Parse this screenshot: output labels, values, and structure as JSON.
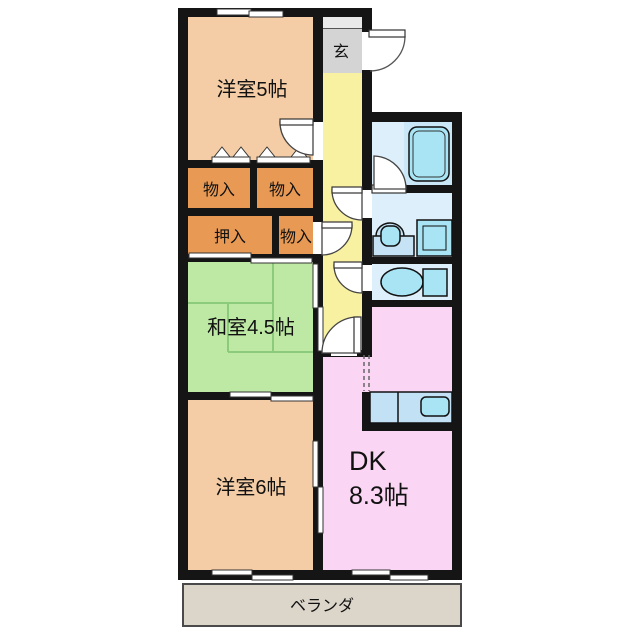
{
  "title": "apartment floor plan",
  "labels": {
    "yoshitsu5": "洋室5帖",
    "genkan": "玄",
    "monoire_a": "物入",
    "monoire_b": "物入",
    "oshiire": "押入",
    "monoire_c": "物入",
    "washitsu": "和室4.5帖",
    "yoshitsu6": "洋室6帖",
    "dk_line1": "DK",
    "dk_line2": "8.3帖",
    "veranda": "ベランダ"
  },
  "colors": {
    "wall": "#151515",
    "western_room": "#F4CDA6",
    "closet": "#E89A55",
    "japanese_room": "#BEE9A4",
    "tatami_line": "#8CCB7C",
    "hallway": "#F9F1A2",
    "genkan": "#D4D4D4",
    "genkan_step": "#E9E9E9",
    "dk": "#FBD6F4",
    "bath_room": "#DDEFFA",
    "bath_tub_zone": "#C9E7F7",
    "fixture_fill": "#A8E4F4",
    "fixture_light": "#C3E1F5",
    "fixture_pale": "#C6E3F6",
    "veranda": "#DCD5C9",
    "veranda_border": "#4A4A4A"
  }
}
